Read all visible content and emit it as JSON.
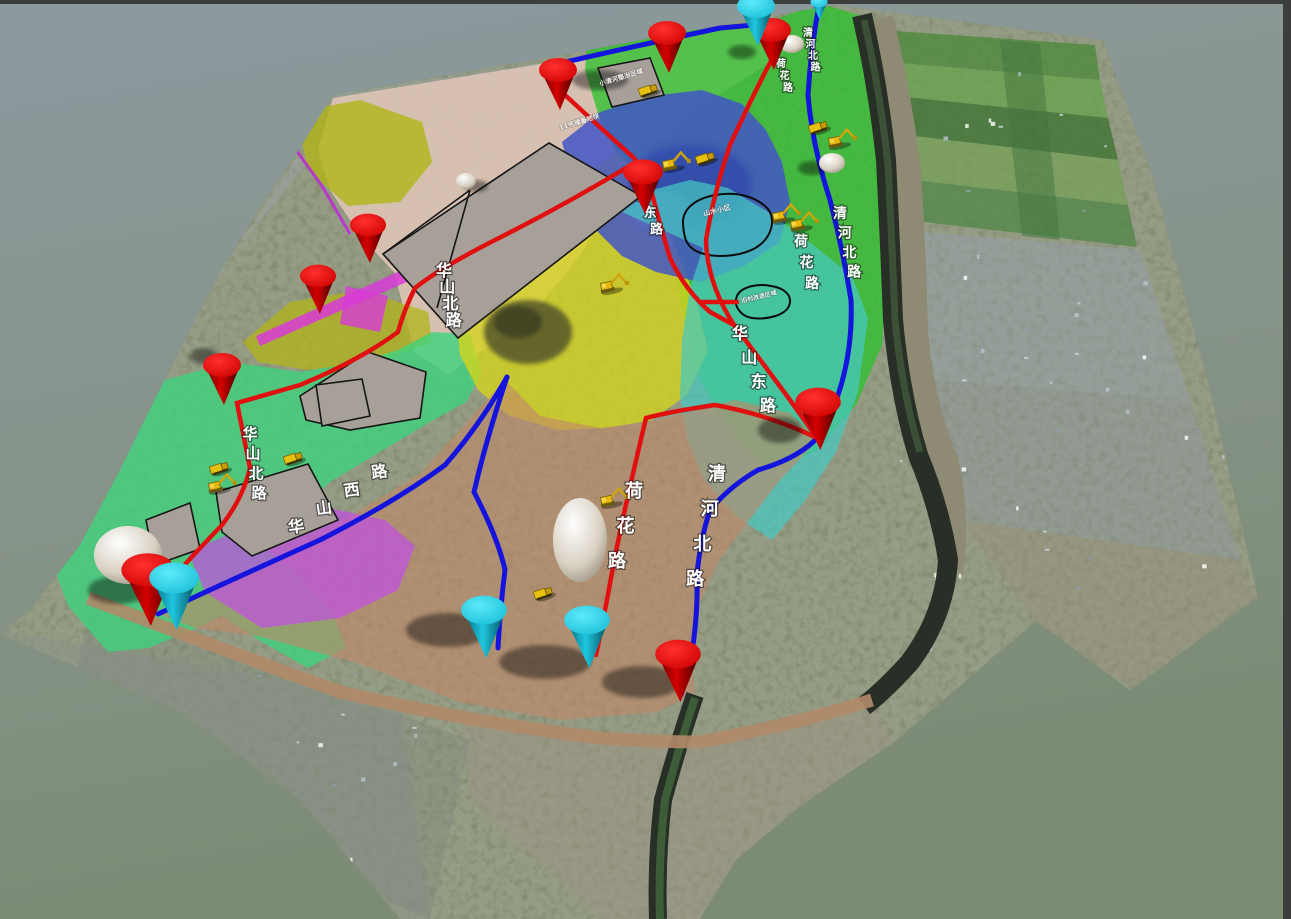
{
  "scene": {
    "type": "3d-terrain-planning-model",
    "viewport": {
      "width": 1291,
      "height": 919
    },
    "background": {
      "top_color": "#8c9aa0",
      "bottom_color": "#7b8b74",
      "frame_color": "#3d3d3d"
    }
  },
  "map": {
    "road_labels": [
      {
        "id": "huashan-north-rd-upper",
        "text": "华山北路",
        "x": 444,
        "y": 276,
        "dx": 3.2,
        "dy": 16.5,
        "size": 16,
        "rotate": 0
      },
      {
        "id": "huashan-east-rd-upper",
        "text": "华山东路",
        "x": 637,
        "y": 184,
        "dx": 6.5,
        "dy": 16.5,
        "size": 13,
        "rotate": 0
      },
      {
        "id": "qinghe-north-rd-top",
        "text": "清河北路",
        "x": 808,
        "y": 36,
        "dx": 2.5,
        "dy": 11.5,
        "size": 10,
        "rotate": 0
      },
      {
        "id": "lotus-rd-top",
        "text": "荷花路",
        "x": 781,
        "y": 67,
        "dx": 3.5,
        "dy": 12,
        "size": 10,
        "rotate": 0
      },
      {
        "id": "qinghe-north-rd-mid",
        "text": "清河北路",
        "x": 840,
        "y": 218,
        "dx": 4.7,
        "dy": 19.5,
        "size": 14,
        "rotate": 0
      },
      {
        "id": "lotus-rd-mid",
        "text": "荷花路",
        "x": 801,
        "y": 246,
        "dx": 5.5,
        "dy": 21,
        "size": 14,
        "rotate": 0
      },
      {
        "id": "huashan-east-rd-mid",
        "text": "华山东路",
        "x": 740,
        "y": 339,
        "dx": 9.3,
        "dy": 24,
        "size": 16,
        "rotate": 0
      },
      {
        "id": "qinghe-north-rd-lower",
        "text": "清河北路",
        "x": 717,
        "y": 480,
        "dx": -7.3,
        "dy": 35,
        "size": 18,
        "rotate": 0
      },
      {
        "id": "lotus-rd-lower",
        "text": "荷花路",
        "x": 634,
        "y": 497,
        "dx": -8.5,
        "dy": 35,
        "size": 18,
        "rotate": 0
      },
      {
        "id": "huashan-north-rd-left",
        "text": "华山北路",
        "x": 250,
        "y": 439,
        "dx": 3,
        "dy": 19.7,
        "size": 15,
        "rotate": 0
      },
      {
        "id": "huashan-west-rd",
        "text": "华山西路",
        "x": 297,
        "y": 532,
        "dx": 27.7,
        "dy": -18.3,
        "size": 16,
        "rotate": -8
      }
    ],
    "area_labels": [
      {
        "id": "redevelopment-area-1",
        "text": "山水小区",
        "x": 704,
        "y": 216,
        "size": 7,
        "rotate": -14
      },
      {
        "id": "redevelopment-area-2",
        "text": "旧村改造区域",
        "x": 742,
        "y": 303,
        "size": 6,
        "rotate": -14
      },
      {
        "id": "corridor-note-1",
        "text": "小清河整治区域",
        "x": 600,
        "y": 86,
        "size": 6.5,
        "rotate": -17
      },
      {
        "id": "corridor-note-2",
        "text": "11号储备地块",
        "x": 560,
        "y": 130,
        "size": 6.5,
        "rotate": -17
      }
    ],
    "markers": {
      "red_cones": [
        {
          "x": 558,
          "y": 70,
          "s": 1
        },
        {
          "x": 667,
          "y": 33,
          "s": 1
        },
        {
          "x": 772,
          "y": 30,
          "s": 1
        },
        {
          "x": 643,
          "y": 172,
          "s": 1.05
        },
        {
          "x": 368,
          "y": 225,
          "s": 0.95
        },
        {
          "x": 318,
          "y": 276,
          "s": 0.95
        },
        {
          "x": 222,
          "y": 365,
          "s": 1
        },
        {
          "x": 148,
          "y": 570,
          "s": 1.4
        },
        {
          "x": 818,
          "y": 402,
          "s": 1.2
        },
        {
          "x": 678,
          "y": 654,
          "s": 1.2
        }
      ],
      "cyan_cones": [
        {
          "x": 756,
          "y": 6,
          "s": 1
        },
        {
          "x": 819,
          "y": 2,
          "s": 0.45
        },
        {
          "x": 174,
          "y": 578,
          "s": 1.3
        },
        {
          "x": 484,
          "y": 610,
          "s": 1.2
        },
        {
          "x": 587,
          "y": 620,
          "s": 1.2
        }
      ]
    },
    "vehicles": {
      "excavators": [
        {
          "x": 216,
          "y": 486
        },
        {
          "x": 608,
          "y": 286
        },
        {
          "x": 608,
          "y": 500
        },
        {
          "x": 670,
          "y": 164
        },
        {
          "x": 780,
          "y": 216
        },
        {
          "x": 798,
          "y": 224
        },
        {
          "x": 836,
          "y": 141
        }
      ],
      "dump_trucks": [
        {
          "x": 648,
          "y": 90
        },
        {
          "x": 705,
          "y": 158
        },
        {
          "x": 818,
          "y": 127
        },
        {
          "x": 293,
          "y": 458
        },
        {
          "x": 543,
          "y": 593
        },
        {
          "x": 219,
          "y": 468
        }
      ]
    },
    "structures": {
      "white_mounds": [
        {
          "x": 792,
          "y": 44,
          "rx": 12,
          "ry": 9
        },
        {
          "x": 832,
          "y": 163,
          "rx": 13,
          "ry": 10
        },
        {
          "x": 466,
          "y": 181,
          "rx": 10,
          "ry": 8
        },
        {
          "x": 580,
          "y": 540,
          "rx": 27,
          "ry": 42
        },
        {
          "x": 128,
          "y": 555,
          "rx": 34,
          "ry": 29
        }
      ]
    },
    "colors": {
      "zones": {
        "parkland_green": "#2ec22e",
        "turquoise": "#45c8c0",
        "quarry_blue": "#4255c5",
        "farmland_yellow": "#d6d51b",
        "olive": "#b2b418",
        "mint_green": "#3cd47e",
        "magenta": "#d83ad8",
        "purple_parcel": "#c050e0",
        "pale_pink_corridor": "#dcc3b4",
        "tan_brown": "#c08868",
        "parcel_gray": "#a7a099"
      },
      "roads": {
        "red_road": "#e01010",
        "blue_road": "#1414dd"
      },
      "markers": {
        "red_cone": "#dd0000",
        "cyan_cone": "#22c8e4"
      }
    }
  }
}
